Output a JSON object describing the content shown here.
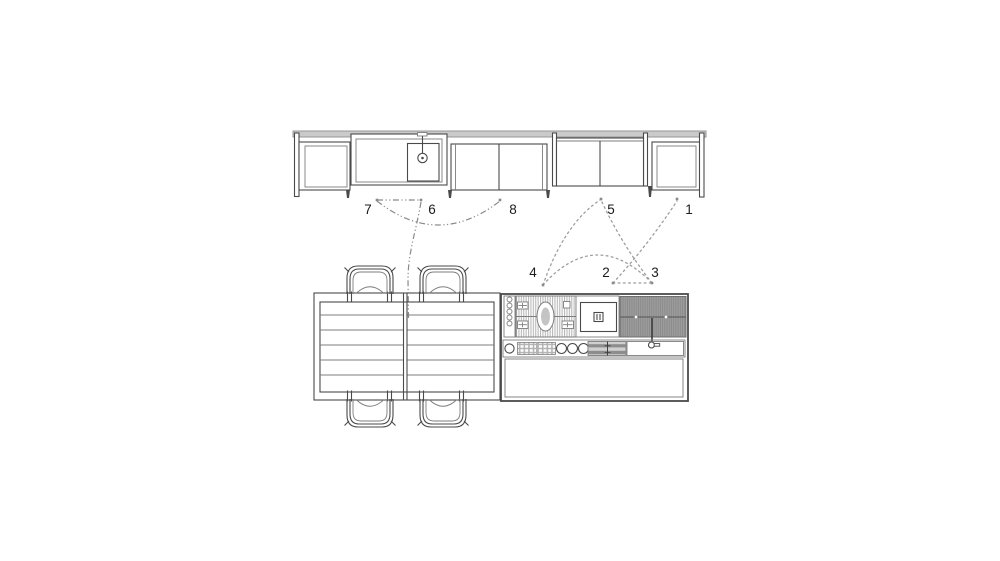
{
  "callouts": {
    "n1": {
      "label": "1"
    },
    "n2": {
      "label": "2"
    },
    "n3": {
      "label": "3"
    },
    "n4": {
      "label": "4"
    },
    "n5": {
      "label": "5"
    },
    "n6": {
      "label": "6"
    },
    "n7": {
      "label": "7"
    },
    "n8": {
      "label": "8"
    }
  },
  "colors": {
    "background": "#ffffff",
    "line": "#4a4a4a",
    "line_light": "#7d7d7d",
    "leader_dotted": "#9e9e9e",
    "leader_dashdot": "#8a8a8a",
    "countertop_fill": "#cacaca",
    "grill_stripe_light": "#b9b9b9",
    "island_dark_fill": "#9d9d9d",
    "island_dark_stripe": "#8b8b8b",
    "control_panel_fill": "#b2b2b2",
    "label_text": "#1c1c1c"
  },
  "icons": {
    "elevation_tap": "faucet-icon",
    "plan_tap": "faucet-icon",
    "sink": "sink-basin-icon",
    "cooktop": "cooktop-grill-icon",
    "appliance": "oven-icon",
    "controls": "control-knob-icon"
  }
}
